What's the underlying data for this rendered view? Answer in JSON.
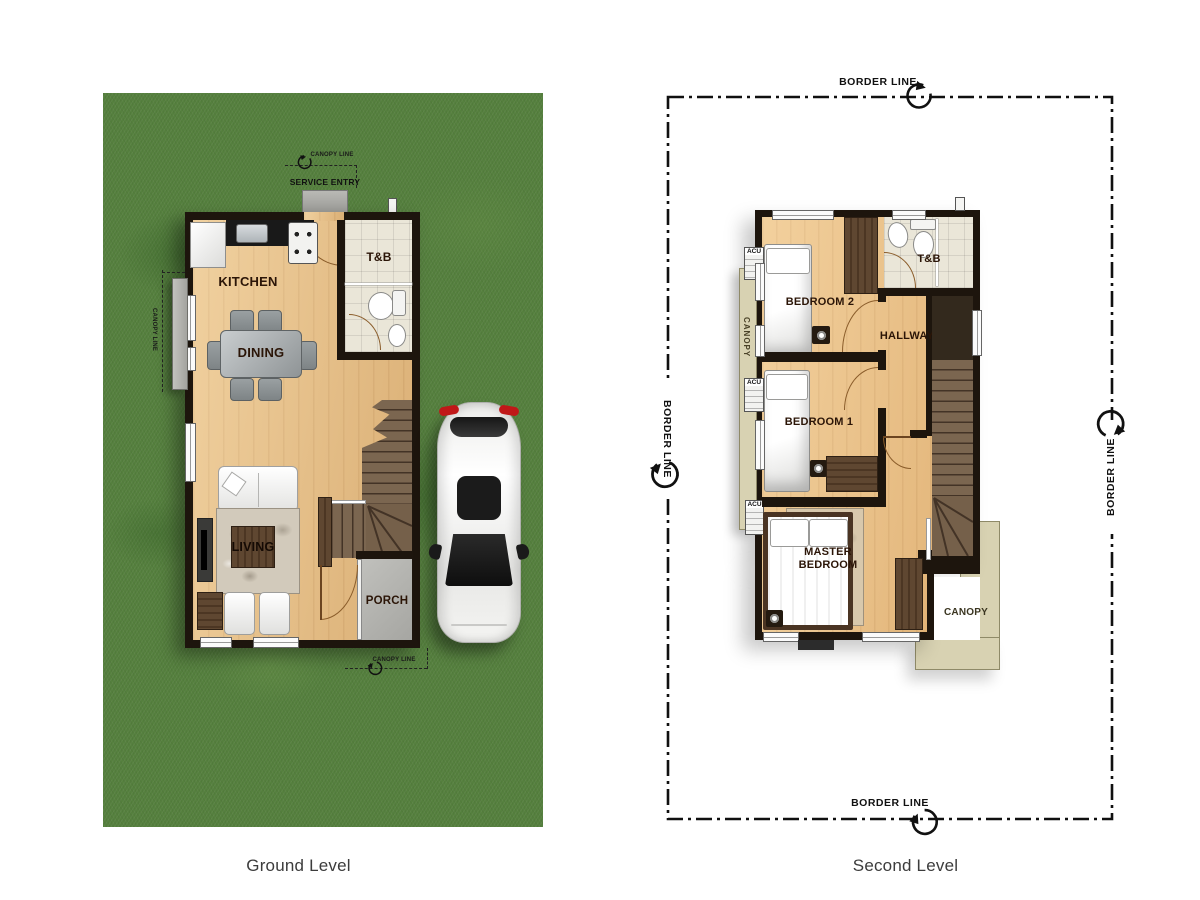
{
  "colors": {
    "grass": "#55803e",
    "wood": "#e7bf85",
    "wood2": "#ecc287",
    "wall": "#1d150d",
    "tile": "#eae6d8",
    "stair": "#75604a",
    "porch": "#b4b4b0",
    "canopy": "#d8d2b2",
    "rug": "#d2cabb",
    "label": "#2b1507",
    "line": "#111111",
    "furniture": "#5a432e",
    "accent_red": "#c01818"
  },
  "ground": {
    "caption": "Ground Level",
    "rooms": {
      "kitchen": "KITCHEN",
      "dining": "DINING",
      "living": "LIVING",
      "toilet_bath": "T&B",
      "porch": "PORCH"
    },
    "annotations": {
      "service_entry": "SERVICE ENTRY",
      "canopy_line": "CANOPY LINE"
    }
  },
  "second": {
    "caption": "Second Level",
    "rooms": {
      "bedroom2": "BEDROOM 2",
      "bedroom1": "BEDROOM 1",
      "master_bedroom": "MASTER BEDROOM",
      "hallway": "HALLWAY",
      "toilet_bath": "T&B"
    },
    "annotations": {
      "border_line": "BORDER LINE",
      "canopy": "CANOPY",
      "acu": "ACU"
    }
  }
}
